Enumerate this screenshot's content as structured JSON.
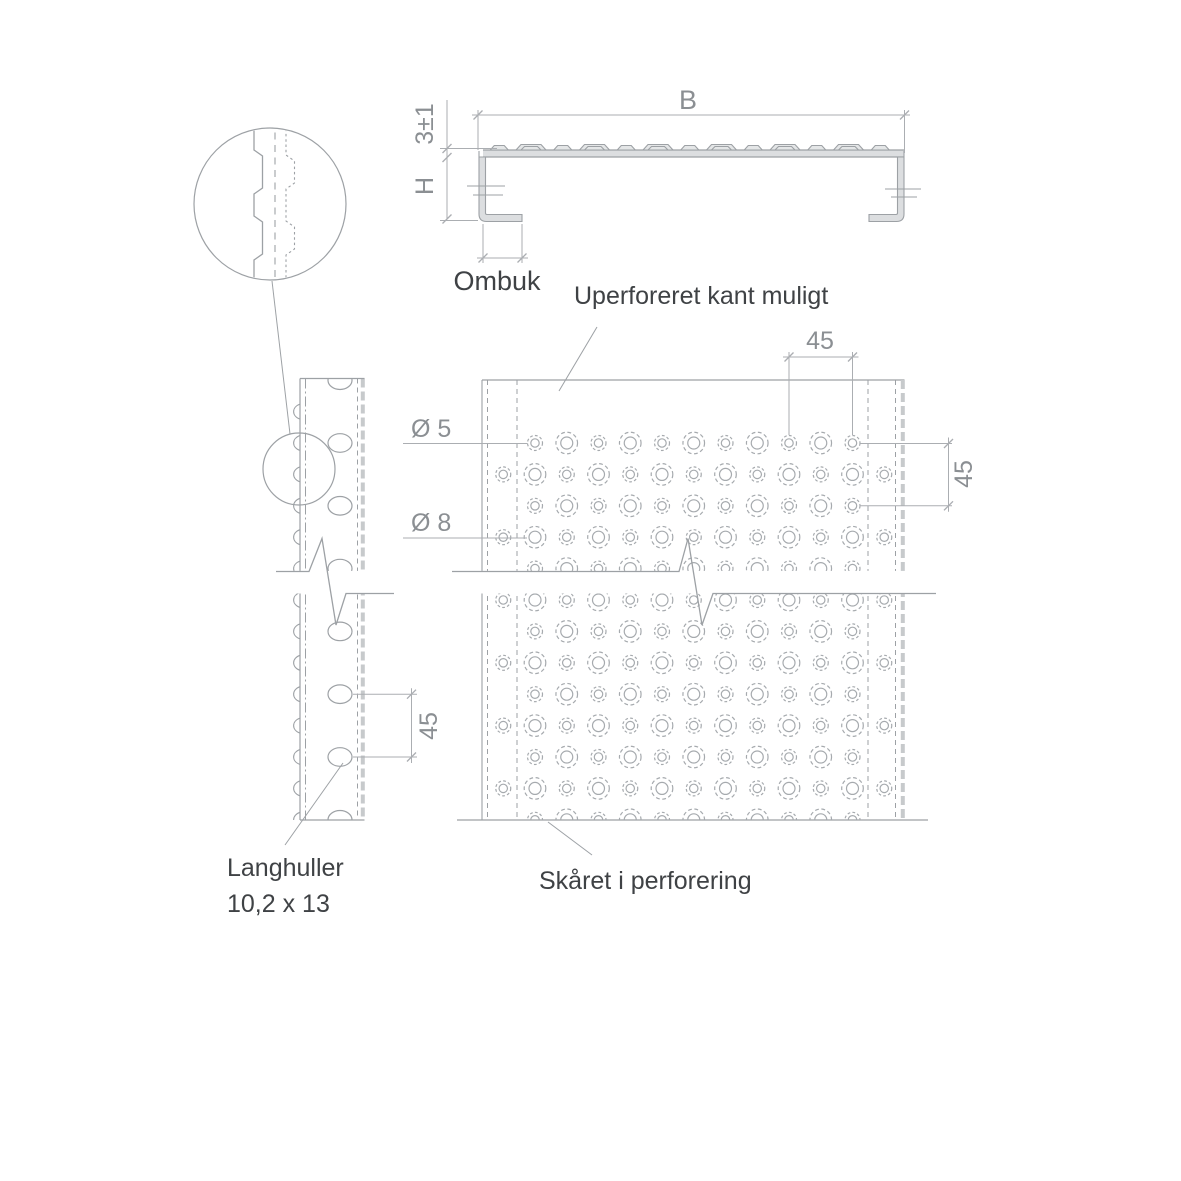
{
  "drawing": {
    "type": "technical-drawing",
    "subject": "perforated steel plank profile",
    "views": [
      "cross-section",
      "edge side view",
      "perforation detail",
      "top view of perforated plate"
    ]
  },
  "labels": {
    "width_dim": "B",
    "height_dim": "H",
    "thickness_dim": "3±1",
    "hem_note": "Ombuk",
    "unperforated_edge_note": "Uperforeret kant muligt",
    "small_hole_dia": "Ø 5",
    "large_hole_dia": "Ø 8",
    "pitch_top": "45",
    "pitch_right": "45",
    "pitch_slots": "45",
    "slot_note_line1": "Langhuller",
    "slot_note_line2": "10,2 x 13",
    "cut_note": "Skåret i perforering"
  },
  "dimensions": {
    "hole_pitch_mm": 45,
    "small_hole_diameter_mm": 5,
    "large_hole_diameter_mm": 8,
    "slot_size_mm": "10,2 x 13",
    "top_thickness_mm": "3±1"
  },
  "colors": {
    "object_line": "#9da1a5",
    "dim_line": "#abaeb2",
    "hole_line": "#a6aaae",
    "thick_edge": "#c7cacc",
    "fill_profile": "#dcdee0",
    "fill_bump": "#e4e6e7",
    "text_dark": "#3f4245",
    "text_dim": "#8b8f93",
    "background": "#ffffff"
  }
}
